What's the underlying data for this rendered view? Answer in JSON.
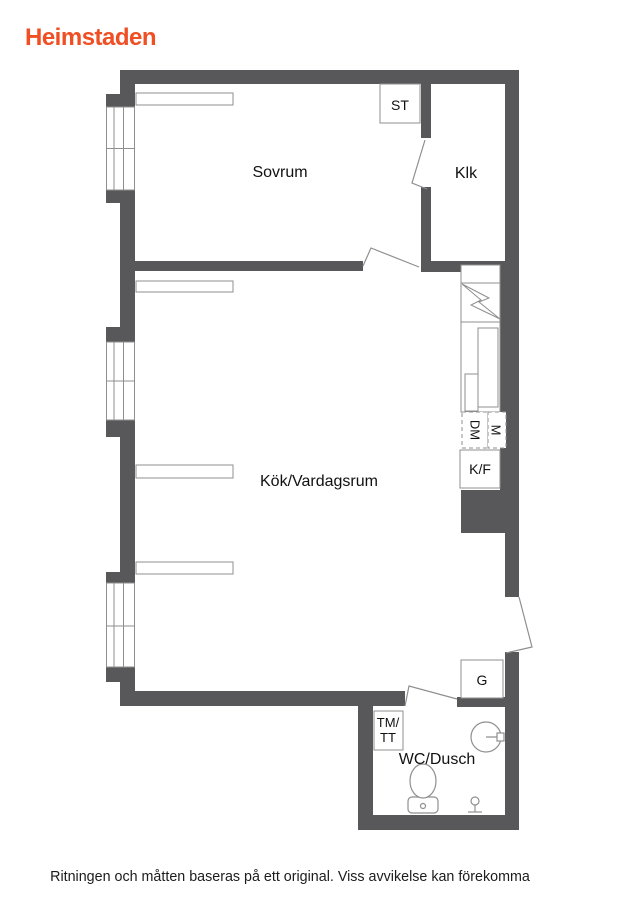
{
  "header": {
    "logo": "Heimstaden"
  },
  "colors": {
    "brand_orange": "#F04E23",
    "wall_gray": "#58585A",
    "line_gray": "#8F8F8F",
    "text_black": "#111111"
  },
  "floorplan": {
    "labels": {
      "bedroom": "Sovrum",
      "closet": "Klk",
      "storage": "ST",
      "kitchen_living": "Kök/Vardagsrum",
      "bathroom": "WC/Dusch",
      "fridge_freezer": "K/F",
      "dishwasher": "DM",
      "appliance_m": "M",
      "wardrobe": "G",
      "washer_line1": "TM/",
      "washer_line2": "TT"
    }
  },
  "footer": {
    "disclaimer": "Ritningen och måtten baseras på ett original. Viss avvikelse kan förekomma"
  }
}
